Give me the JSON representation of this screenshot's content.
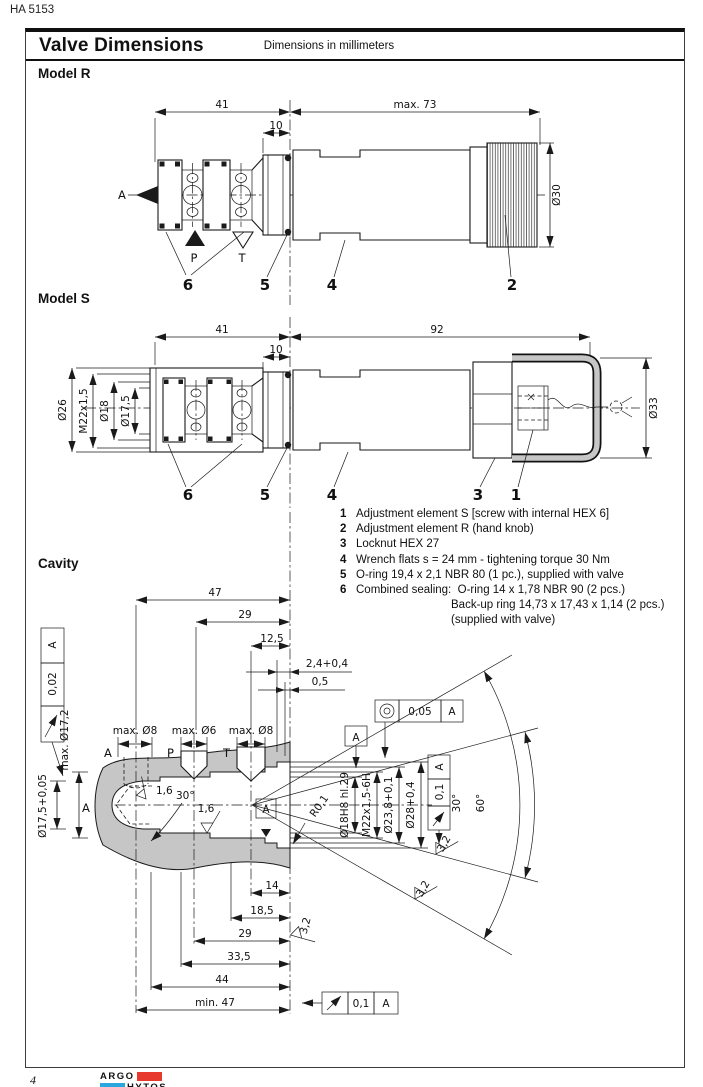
{
  "page": {
    "doc_number": "HA 5153",
    "page_number": "4"
  },
  "title_bar": {
    "title": "Valve Dimensions",
    "subtitle": "Dimensions in millimeters"
  },
  "colors": {
    "accent_red": "#e8392e",
    "accent_blue": "#29a8df",
    "line": "#1a1a1a",
    "shade": "#c6c6c6"
  },
  "model_r": {
    "heading": "Model R",
    "dim_41": "41",
    "dim_10": "10",
    "dim_max73": "max. 73",
    "dim_dia30": "Ø30",
    "port_a": "A",
    "port_p": "P",
    "port_t": "T",
    "callout_6": "6",
    "callout_5": "5",
    "callout_4": "4",
    "callout_2": "2"
  },
  "model_s": {
    "heading": "Model S",
    "dim_41": "41",
    "dim_10": "10",
    "dim_92": "92",
    "dim_dia26": "Ø26",
    "dim_m22": "M22x1,5",
    "dim_dia18": "Ø18",
    "dim_dia175": "Ø17,5",
    "dim_dia33": "Ø33",
    "callout_6": "6",
    "callout_5": "5",
    "callout_4": "4",
    "callout_3": "3",
    "callout_1": "1"
  },
  "legend": {
    "rows": [
      {
        "num": "1",
        "text": "Adjustment element S [screw with internal HEX 6]"
      },
      {
        "num": "2",
        "text": "Adjustment element R (hand knob)"
      },
      {
        "num": "3",
        "text": "Locknut HEX 27"
      },
      {
        "num": "4",
        "text": "Wrench flats s = 24 mm - tightening torque 30 Nm"
      },
      {
        "num": "5",
        "text": "O-ring 19,4 x 2,1 NBR 80 (1 pc.), supplied with valve"
      },
      {
        "num": "6",
        "text": "Combined sealing:  O-ring 14 x 1,78 NBR 90 (2 pcs.)"
      },
      {
        "num": "",
        "text": "Back-up ring 14,73 x 17,43 x 1,14 (2 pcs.)"
      },
      {
        "num": "",
        "text": "(supplied with valve)"
      }
    ]
  },
  "cavity": {
    "heading": "Cavity",
    "dim_47": "47",
    "dim_29_top": "29",
    "dim_125": "12,5",
    "dim_24": "2,4+0,4",
    "dim_05": "0,5",
    "fcf_left_tol": "0,02",
    "fcf_left_datum": "A",
    "dim_max172": "max. Ø17,2",
    "dim_175": "Ø17,5+0,05",
    "datum_a_left": "A",
    "port_a": "A",
    "port_p": "P",
    "port_t": "T",
    "dim_port_a": "max. Ø8",
    "dim_port_p": "max. Ø6",
    "dim_port_t": "max. Ø8",
    "sf_16_cone": "1,6",
    "ang_30_cone": "30°",
    "sf_16_bore": "1,6",
    "datum_box_bore": "A",
    "datum_box_top": "A",
    "fcf_conc_tol": "0,05",
    "fcf_conc_datum": "A",
    "rad_r01": "R0,1",
    "dim_18h8": "Ø18H8 hl.29",
    "dim_m22": "M22x1,5-6H",
    "dim_238": "Ø23,8+0,1",
    "dim_28": "Ø28+0,4",
    "fcf_right_tol": "0,1",
    "fcf_right_datum": "A",
    "ang_30": "30°",
    "ang_60": "60°",
    "sf_32_mouth": "3,2",
    "sf_32_fan1": "3,2",
    "sf_32_fan2": "3,2",
    "dim_14": "14",
    "dim_185": "18,5",
    "dim_29_bot": "29",
    "dim_335": "33,5",
    "dim_44": "44",
    "dim_min47": "min. 47",
    "fcf_bottom_tol": "0,1",
    "fcf_bottom_datum": "A"
  },
  "logo": {
    "argo": "ARGO",
    "hytos": "HYTOS"
  }
}
